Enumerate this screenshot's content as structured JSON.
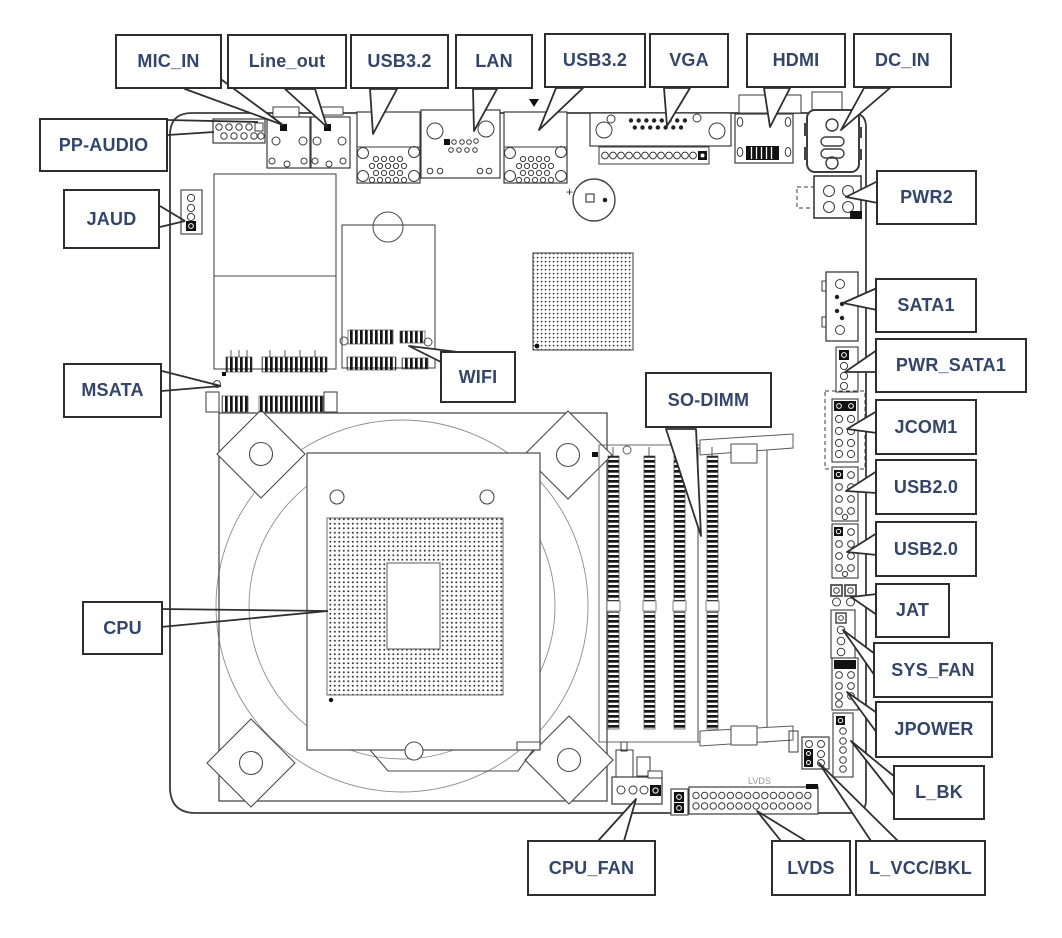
{
  "diagram": {
    "title": "motherboard connector location diagram",
    "labels": {
      "mic_in": "MIC_IN",
      "line_out": "Line_out",
      "usb32_a": "USB3.2",
      "lan": "LAN",
      "usb32_b": "USB3.2",
      "vga": "VGA",
      "hdmi": "HDMI",
      "dc_in": "DC_IN",
      "pp_audio": "PP-AUDIO",
      "jaud": "JAUD",
      "msata": "MSATA",
      "wifi": "WIFI",
      "cpu": "CPU",
      "so_dimm": "SO-DIMM",
      "pwr2": "PWR2",
      "sata1": "SATA1",
      "pwr_sata1": "PWR_SATA1",
      "jcom1": "JCOM1",
      "usb20_a": "USB2.0",
      "usb20_b": "USB2.0",
      "jat": "JAT",
      "sys_fan": "SYS_FAN",
      "jpower": "JPOWER",
      "l_bk": "L_BK",
      "cpu_fan": "CPU_FAN",
      "lvds": "LVDS",
      "l_vcc_bkl": "L_VCC/BKL"
    },
    "board_texts": {
      "lvds_silkscreen": "LVDS",
      "battery_plus": "+"
    },
    "colors": {
      "label_text": "#31456e",
      "box_border": "#2d2d2d",
      "line": "#3b3b3b",
      "background": "#ffffff"
    }
  }
}
